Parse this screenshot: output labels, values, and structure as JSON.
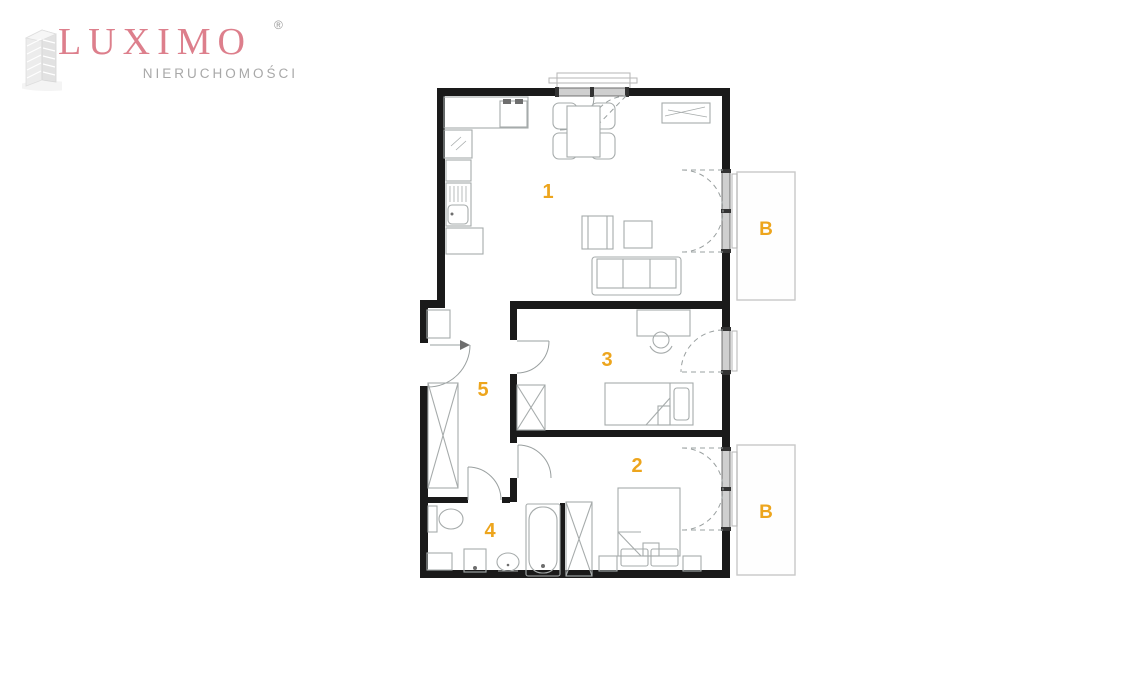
{
  "logo": {
    "brand": "LUXIMO",
    "registered": "®",
    "subtitle": "NIERUCHOMOŚCI",
    "brand_color": "#dd7f8c",
    "subtitle_color": "#a8a8a8"
  },
  "floor_plan": {
    "label_color": "#eda51d",
    "wall_color": "#1a1a1a",
    "furniture_color": "#a6abab",
    "rooms": [
      {
        "id": "room-1",
        "label": "1",
        "x": 548,
        "y": 198
      },
      {
        "id": "room-2",
        "label": "2",
        "x": 637,
        "y": 472
      },
      {
        "id": "room-3",
        "label": "3",
        "x": 607,
        "y": 366
      },
      {
        "id": "room-4",
        "label": "4",
        "x": 490,
        "y": 537
      },
      {
        "id": "room-5",
        "label": "5",
        "x": 483,
        "y": 396
      }
    ],
    "balconies": [
      {
        "id": "balcony-top",
        "label": "B",
        "x": 766,
        "y": 235
      },
      {
        "id": "balcony-bottom",
        "label": "B",
        "x": 766,
        "y": 518
      }
    ]
  }
}
